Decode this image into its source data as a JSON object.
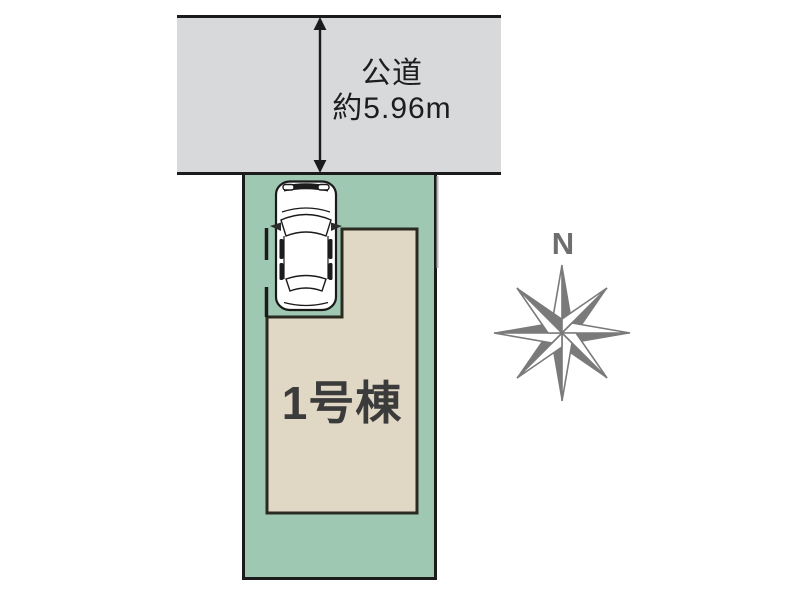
{
  "plan": {
    "road": {
      "name": "公道",
      "width": "約5.96m"
    },
    "building": {
      "label": "1号棟"
    },
    "compass": {
      "north_label": "N"
    },
    "icons": {
      "car": "car-top-view-icon",
      "compass": "compass-rose-icon",
      "dimension_arrow": "double-arrow-vertical-icon"
    },
    "colors": {
      "road_fill": "#d8d9da",
      "lot_fill": "#9fc8b2",
      "building_fill": "#e0d7c4",
      "outline": "#1b1b1b",
      "building_outline": "#2a2a20",
      "compass_gray": "#7a7a7a",
      "text": "#1d1d1d",
      "building_text": "#3b3b3b"
    }
  }
}
